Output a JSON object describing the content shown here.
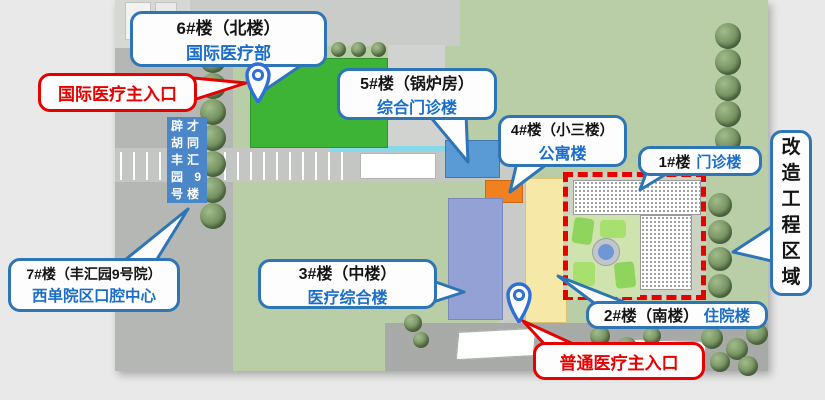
{
  "callouts": {
    "building6": {
      "line1": "6#楼（北楼）",
      "line2": "国际医疗部"
    },
    "building5": {
      "line1": "5#楼（锅炉房）",
      "line2": "综合门诊楼"
    },
    "building4": {
      "line1": "4#楼（小三楼）",
      "line2": "公寓楼"
    },
    "building3": {
      "line1": "3#楼（中楼）",
      "line2": "医疗综合楼"
    },
    "building7": {
      "line1": "7#楼（丰汇园9号院）",
      "line2": "西单院区口腔中心"
    },
    "building1": {
      "number": "1#楼",
      "name": "门诊楼"
    },
    "building2": {
      "number": "2#楼（南楼）",
      "name": "住院楼"
    },
    "renovation_zone": {
      "chars": [
        "改",
        "造",
        "工",
        "程",
        "区",
        "域"
      ]
    },
    "entrance_international": {
      "label": "国际医疗主入口"
    },
    "entrance_general": {
      "label": "普通医疗主入口"
    },
    "address_box": {
      "rows": [
        "辟才",
        "胡同",
        "丰汇",
        "园 9",
        "号楼"
      ]
    }
  },
  "colors": {
    "callout_border_blue": "#2e75b6",
    "callout_text_blue": "#1b6ec8",
    "callout_red": "#e60000",
    "building_6_green": "#3eb436",
    "building_5_blue": "#5b9bd5",
    "building_4_orange": "#f08020",
    "building_3_lavender": "#94a1d4",
    "building_2_yellow": "#f6e8a6",
    "renovation_border_red": "#e80000",
    "address_box_blue": "#4b86c8",
    "grass_green": "#b9cea6"
  },
  "icons": {
    "entrance_marker": "location-pin"
  }
}
